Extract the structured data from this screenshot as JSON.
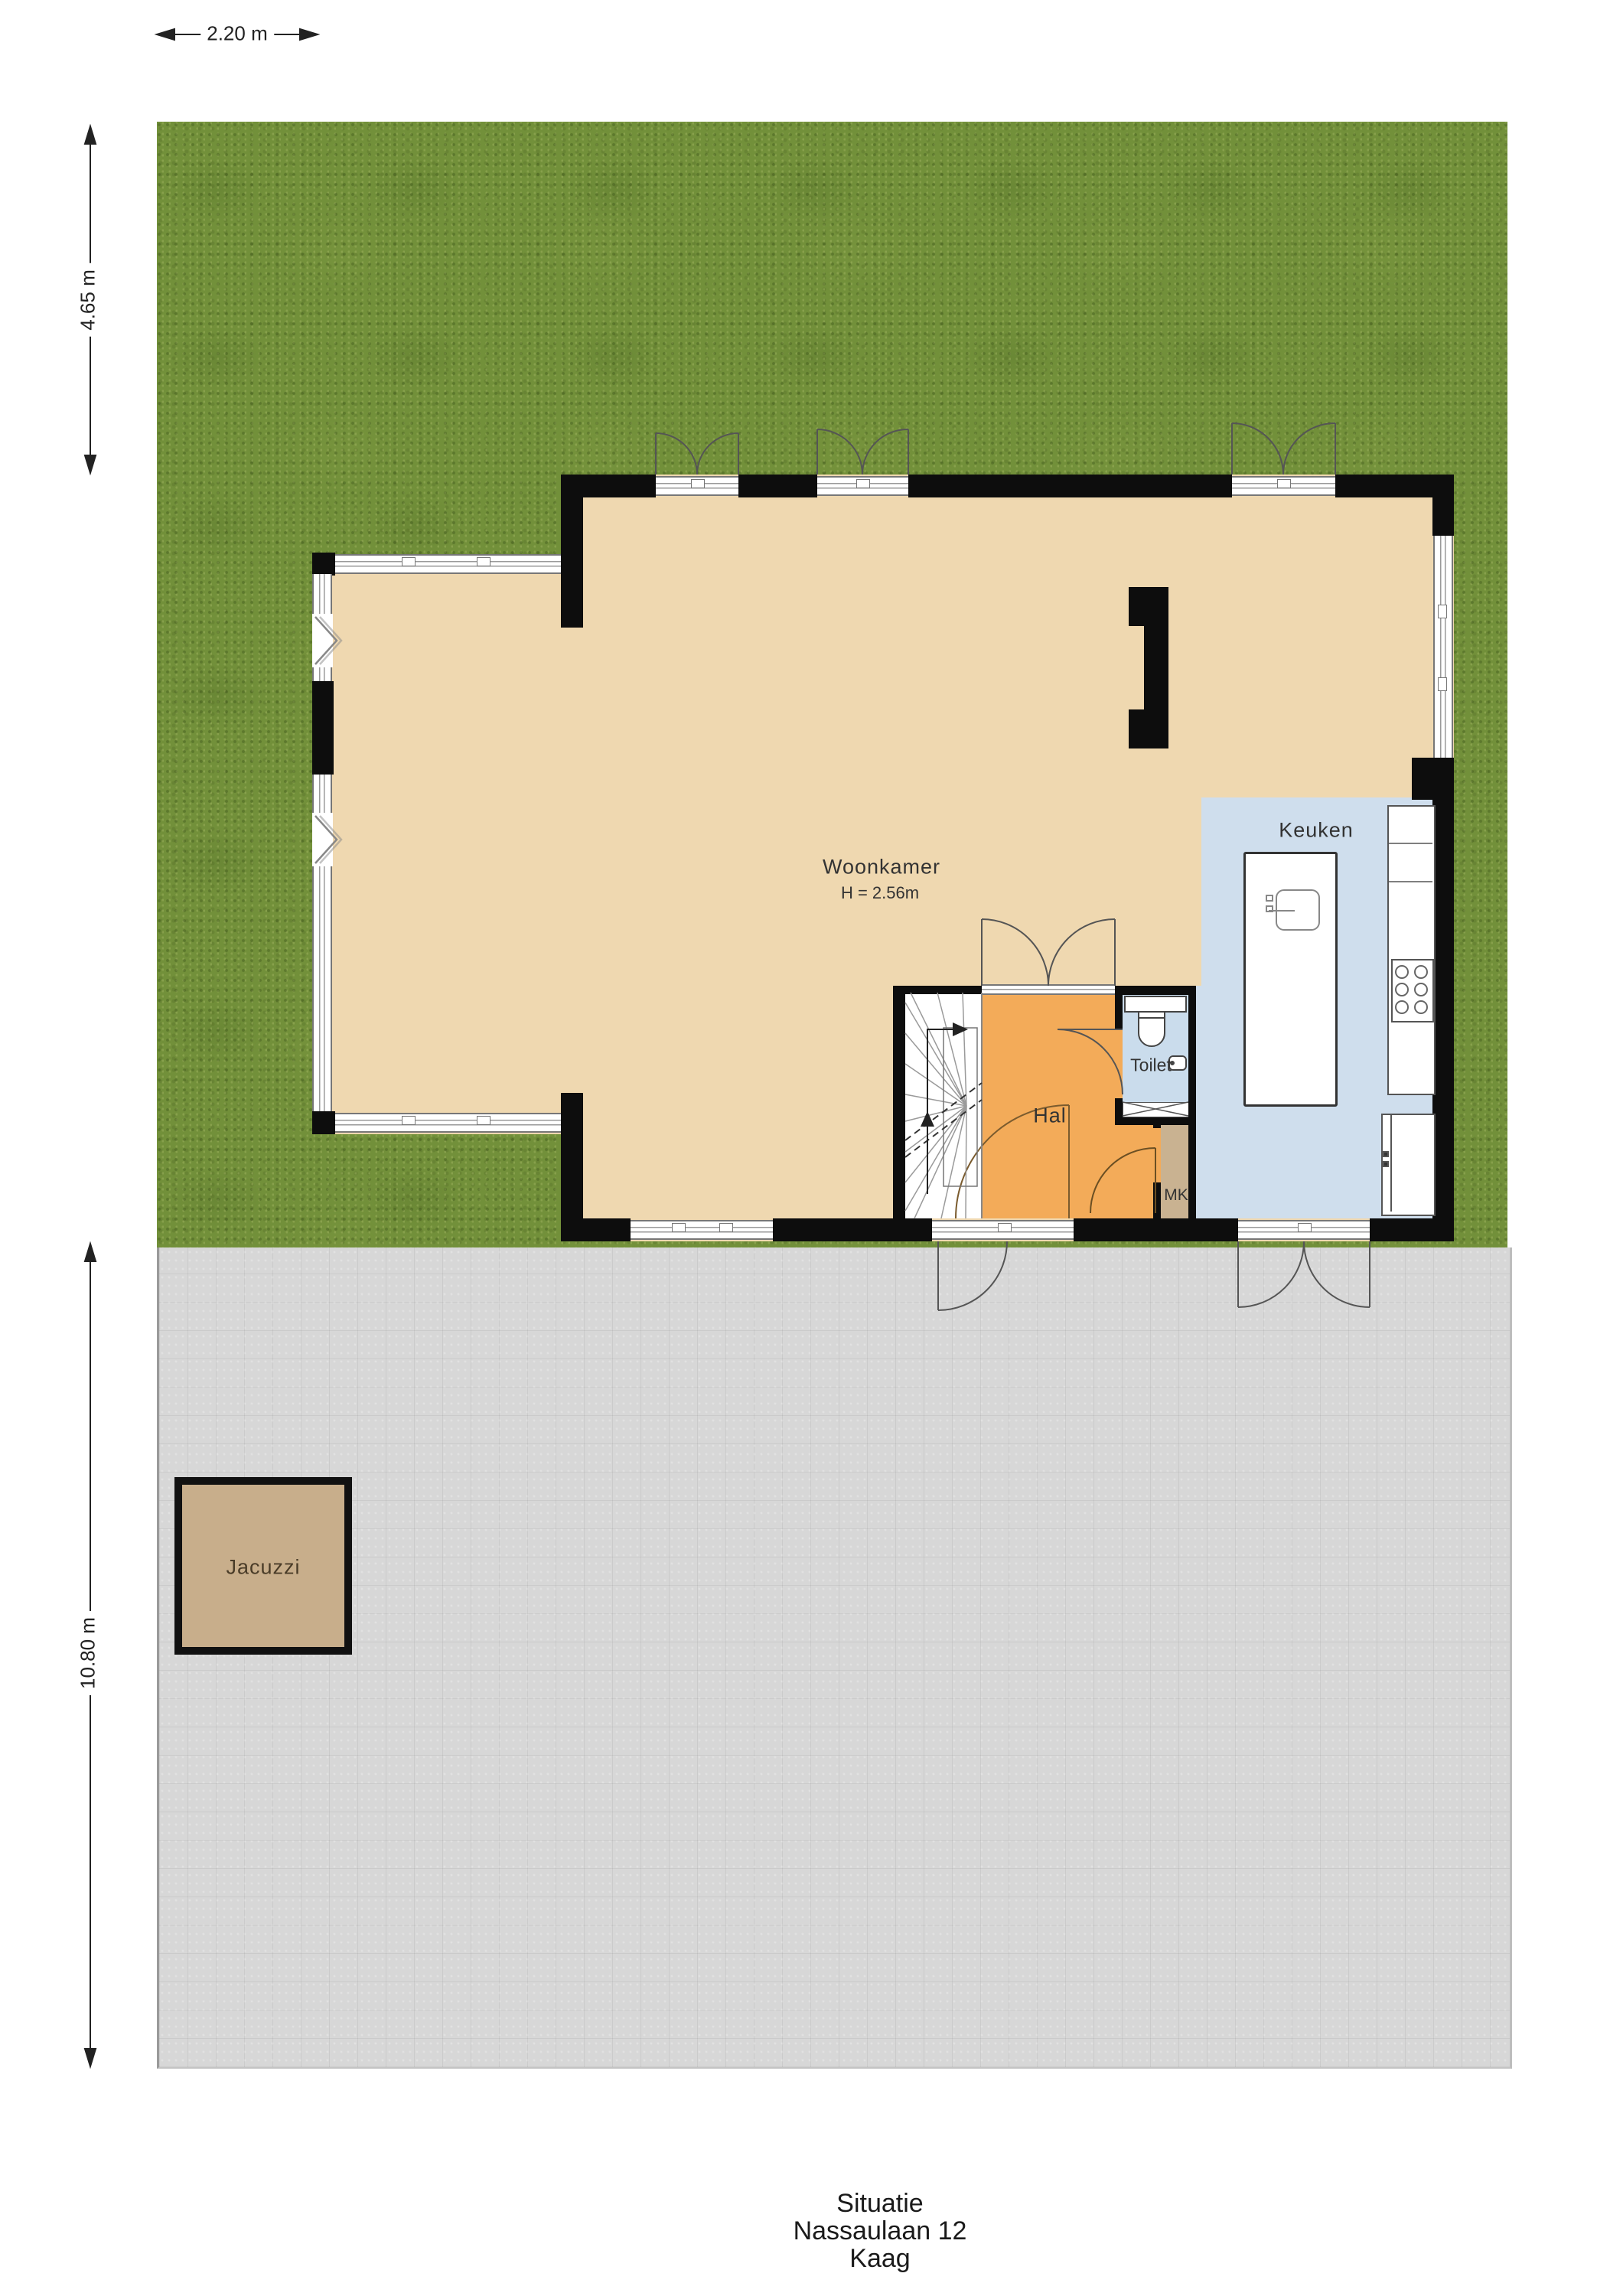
{
  "title_block": {
    "line1": "Situatie",
    "line2": "Nassaulaan 12",
    "line3": "Kaag"
  },
  "dimensions": {
    "top_width": "2.20 m",
    "garden_height": "4.65 m",
    "terrace_height": "10.80 m"
  },
  "rooms": {
    "woonkamer": {
      "label": "Woonkamer",
      "ceiling_height": "H = 2.56m"
    },
    "keuken": {
      "label": "Keuken"
    },
    "hal": {
      "label": "Hal"
    },
    "toilet": {
      "label": "Toilet"
    },
    "mk": {
      "label": "MK"
    },
    "jacuzzi": {
      "label": "Jacuzzi"
    }
  },
  "colors": {
    "grass": "#72903a",
    "paving": "#d7d7d7",
    "wall": "#0d0d0d",
    "wood_floor": "#efd8b0",
    "kitchen_floor": "#cfdeed",
    "hal_floor": "#f3ab59",
    "toilet_floor": "#cadcec",
    "mk_floor": "#c9b291",
    "jacuzzi": "#c8ae8b",
    "line": "#555555"
  }
}
